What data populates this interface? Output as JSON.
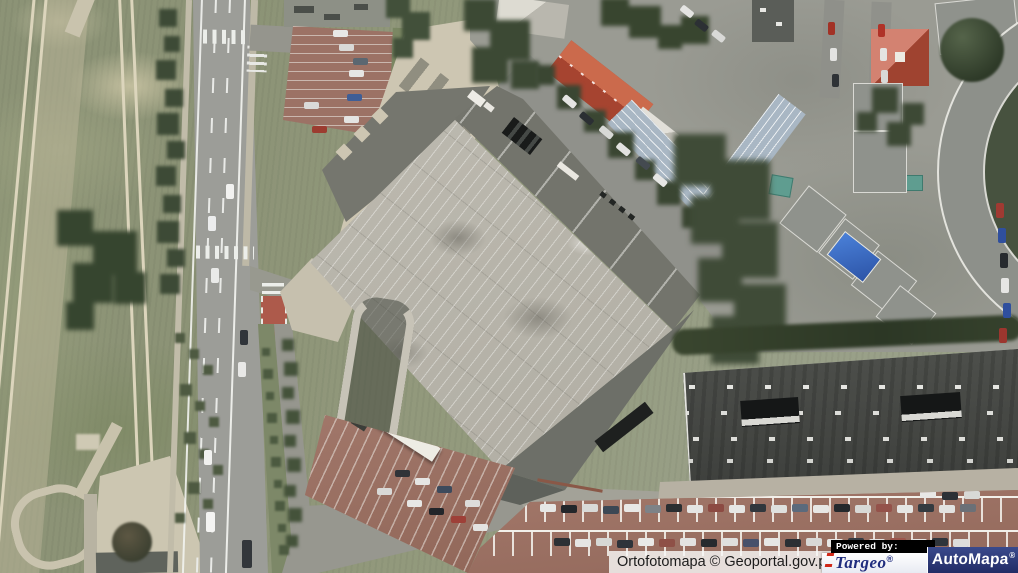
{
  "map": {
    "type": "aerial-orthophoto",
    "features": [
      "grass-field",
      "tram-tracks",
      "tree-line",
      "main-road",
      "pedestrian-crossing",
      "bike-crossing",
      "shopping-mall-rooftop-parking",
      "mall-roof",
      "parking-ramp",
      "brick-parking-lot",
      "concrete-pad",
      "red-tile-rowhouse",
      "blue-metal-roof-building",
      "red-hip-roof-building",
      "apartment-blocks",
      "blue-tarp-roof",
      "curved-apartment-building",
      "warehouse-roof",
      "skylights",
      "car-park-rows",
      "hedge",
      "woodland",
      "tram-platform",
      "bus"
    ]
  },
  "attribution": {
    "map_credit": "Ortofotomapa © Geoportal.gov.pl",
    "powered_by": "Powered by:",
    "targeo": {
      "name": "Targeo",
      "reg": "®"
    },
    "automapa": {
      "name": "AutoMapa",
      "reg": "®"
    }
  },
  "colors": {
    "grass": "#8f967a",
    "road": "#9c9d98",
    "rooftop_parking": "#b6b3a9",
    "mall_roof_dark": "#73746c",
    "warehouse_roof": "#454744",
    "brick_parking": "#9b7164",
    "tree_dark": "#3a462f",
    "red_roof": "#c2523a",
    "blue_roof": "#a9b7c4",
    "tarp_blue": "#3a6cc4",
    "targeo_blue": "#202d7e",
    "targeo_red": "#d02818",
    "automapa_navy": "#222c66",
    "attribution_bg": "#f8f8f6"
  }
}
